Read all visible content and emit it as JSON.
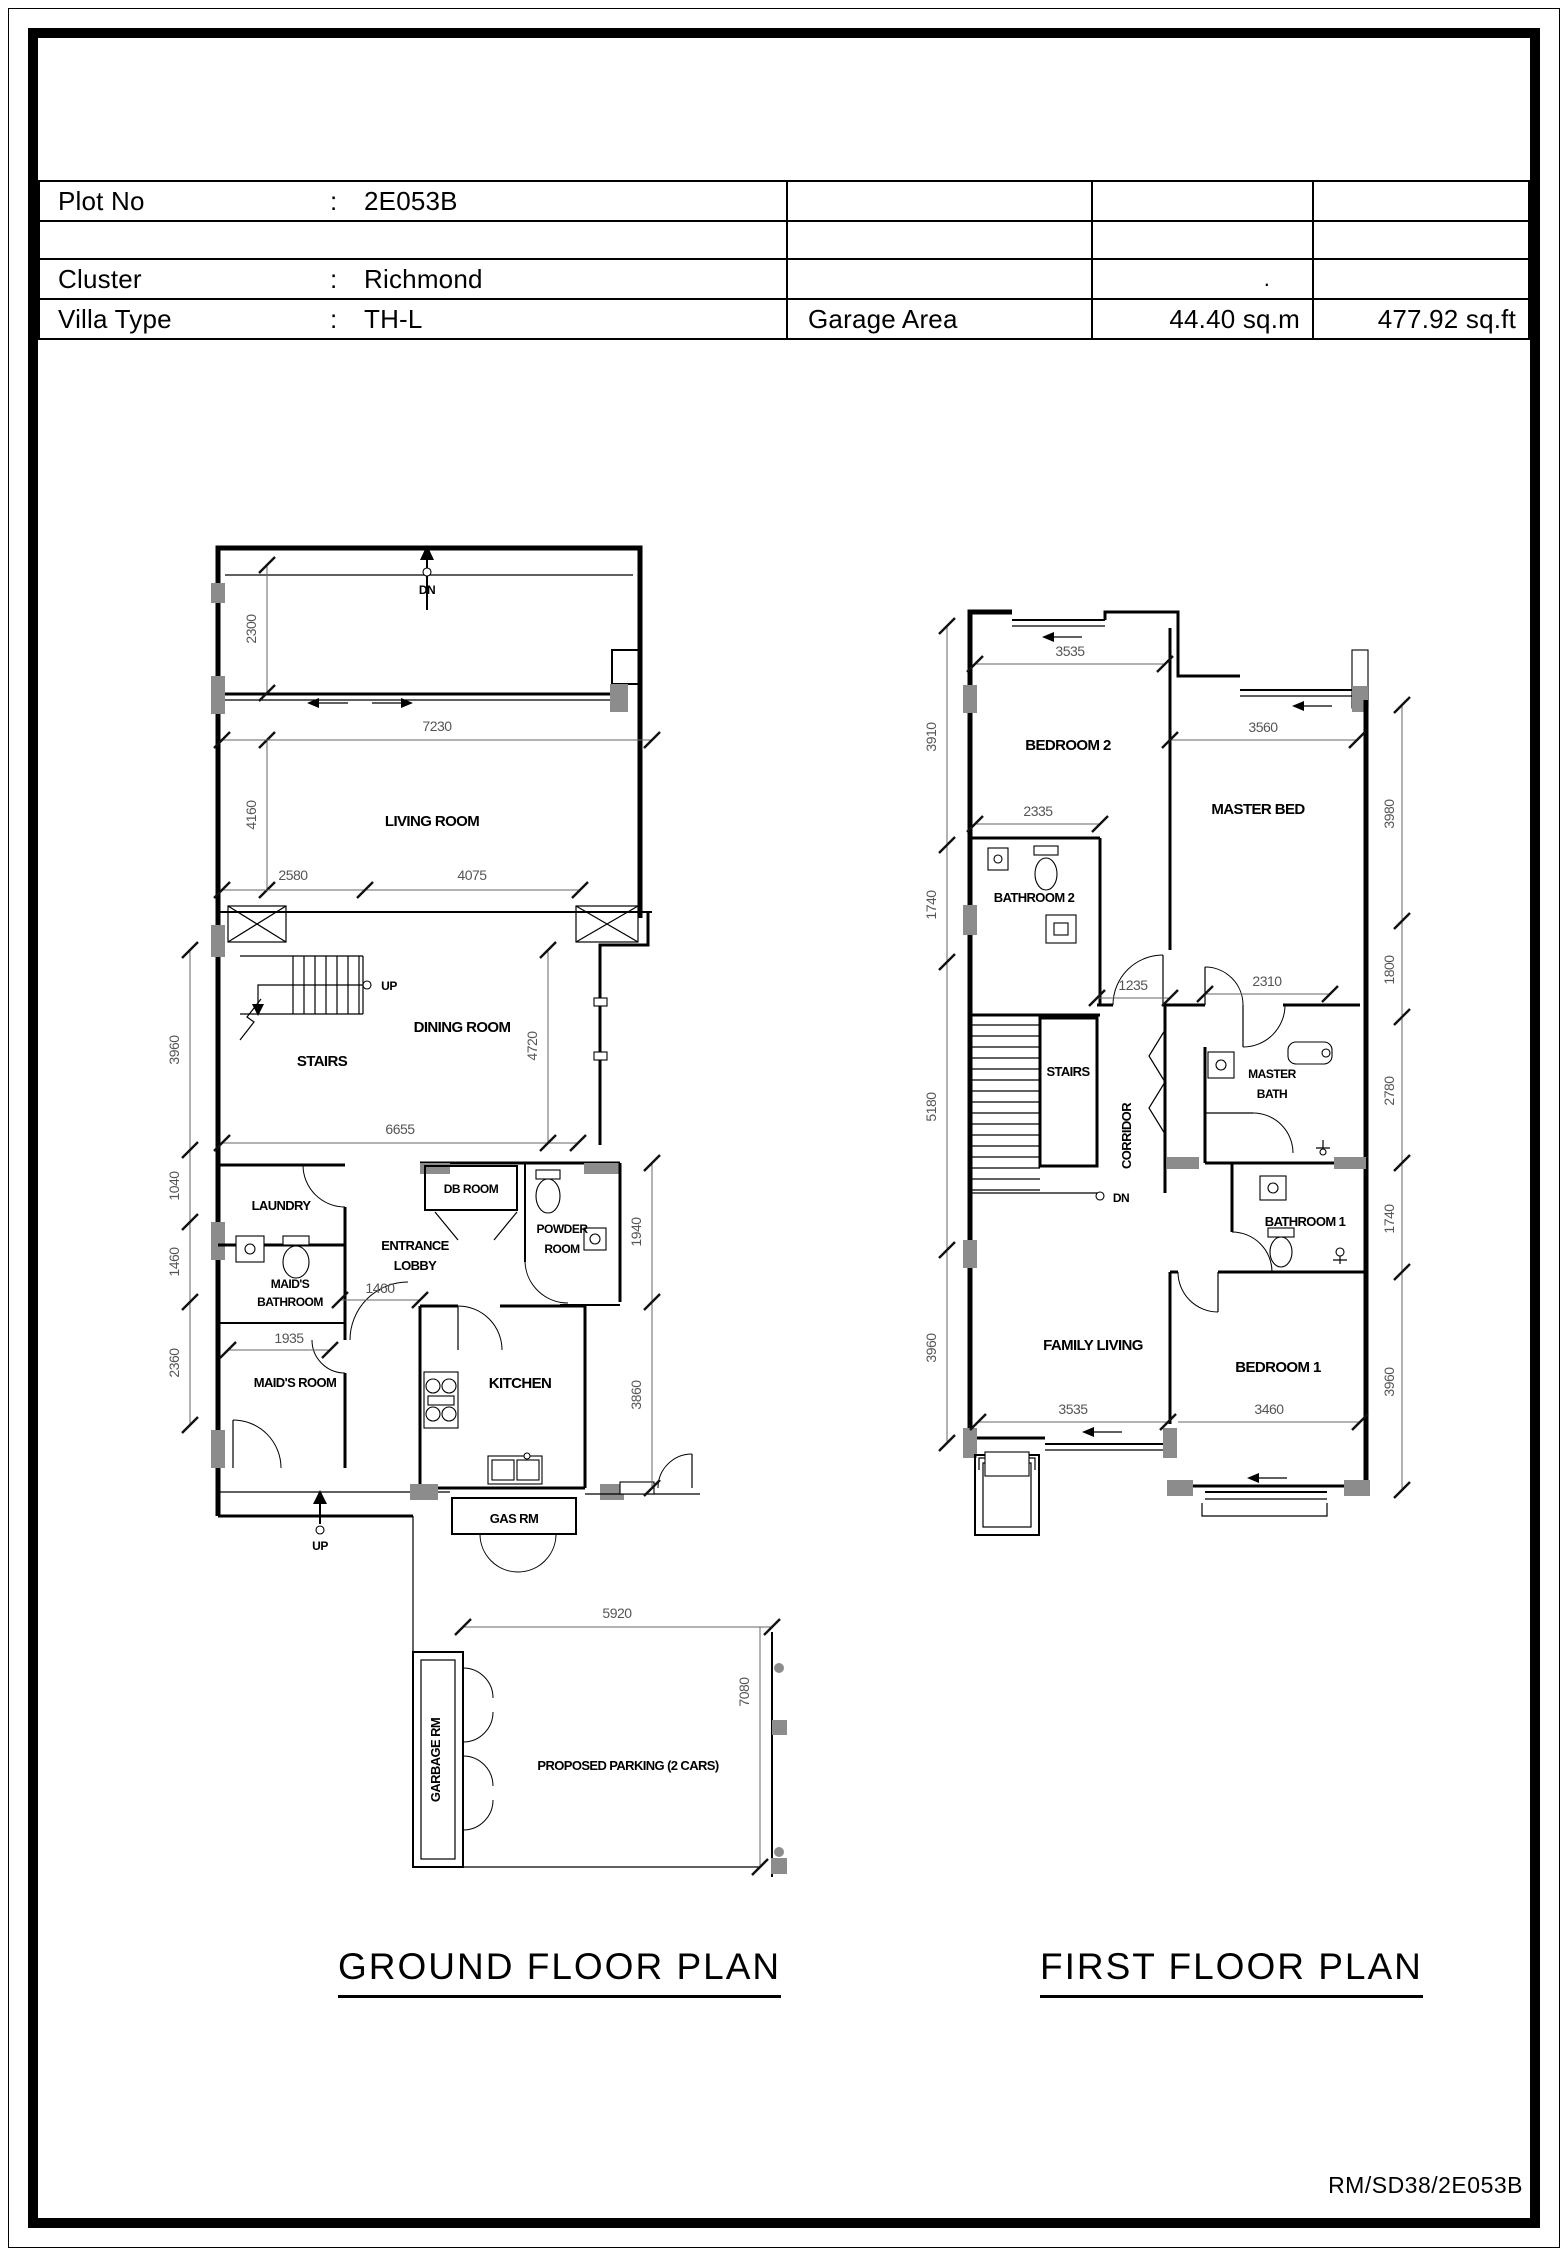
{
  "header": {
    "plot": {
      "label": "Plot No",
      "colon": ":",
      "value": "2E053B"
    },
    "cluster": {
      "label": "Cluster",
      "colon": ":",
      "value": "Richmond",
      "stray_dot": "."
    },
    "villa": {
      "label": "Villa Type",
      "colon": ":",
      "value": "TH-L"
    },
    "garage": {
      "label": "Garage Area",
      "area_sqm": "44.40 sq.m",
      "area_sqft": "477.92 sq.ft"
    }
  },
  "ground_floor": {
    "title": "GROUND FLOOR PLAN",
    "rooms": {
      "living": "LIVING ROOM",
      "dining": "DINING ROOM",
      "stairs": "STAIRS",
      "laundry": "LAUNDRY",
      "db_room": "DB ROOM",
      "powder_1": "POWDER",
      "powder_2": "ROOM",
      "lobby_1": "ENTRANCE",
      "lobby_2": "LOBBY",
      "maid_bath_1": "MAID'S",
      "maid_bath_2": "BATHROOM",
      "maid_room": "MAID'S ROOM",
      "kitchen": "KITCHEN",
      "gas_room": "GAS RM",
      "garbage_room": "GARBAGE RM",
      "parking": "PROPOSED PARKING (2 CARS)"
    },
    "labels": {
      "dn": "DN",
      "up_stairs": "UP",
      "up_entry": "UP"
    },
    "dims": {
      "w7230": "7230",
      "w2580": "2580",
      "w4075": "4075",
      "w6655": "6655",
      "w1460": "1460",
      "w1935": "1935",
      "w5920": "5920",
      "h2300": "2300",
      "h4160": "4160",
      "h3960": "3960",
      "h1040": "1040",
      "h1460": "1460",
      "h2360": "2360",
      "h4720": "4720",
      "h1940": "1940",
      "h3860": "3860",
      "h7080": "7080"
    }
  },
  "first_floor": {
    "title": "FIRST FLOOR PLAN",
    "rooms": {
      "bedroom2": "BEDROOM 2",
      "master_bed": "MASTER BED",
      "bathroom2": "BATHROOM 2",
      "stairs": "STAIRS",
      "corridor": "CORRIDOR",
      "master_bath_1": "MASTER",
      "master_bath_2": "BATH",
      "bathroom1": "BATHROOM 1",
      "family_living": "FAMILY LIVING",
      "bedroom1": "BEDROOM 1"
    },
    "labels": {
      "dn": "DN"
    },
    "dims": {
      "t3535": "3535",
      "t3560": "3560",
      "w2335": "2335",
      "w1235": "1235",
      "w2310": "2310",
      "b3535": "3535",
      "b3460": "3460",
      "l3910": "3910",
      "l1740": "1740",
      "l5180": "5180",
      "l3960": "3960",
      "r3980": "3980",
      "r1800": "1800",
      "r2780": "2780",
      "r1740": "1740",
      "r3960": "3960"
    }
  },
  "footer": {
    "drawing_ref": "RM/SD38/2E053B"
  },
  "colors": {
    "line": "#000000",
    "dim_text": "#555555",
    "wall_fill": "#8c8c8c",
    "paper": "#ffffff"
  }
}
